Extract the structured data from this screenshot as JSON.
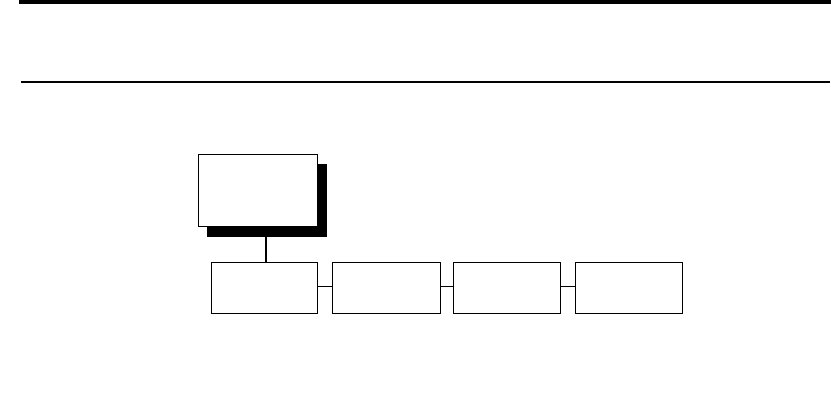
{
  "page": {
    "background_color": "#ffffff",
    "top_bar_color": "#000000",
    "divider_color": "#000000"
  },
  "diagram": {
    "type": "tree",
    "line_color": "#000000",
    "node_fill": "#ffffff",
    "node_border_color": "#000000",
    "root": {
      "label": "",
      "shadow_color": "#000000"
    },
    "children": [
      {
        "label": ""
      },
      {
        "label": ""
      },
      {
        "label": ""
      },
      {
        "label": ""
      }
    ]
  }
}
